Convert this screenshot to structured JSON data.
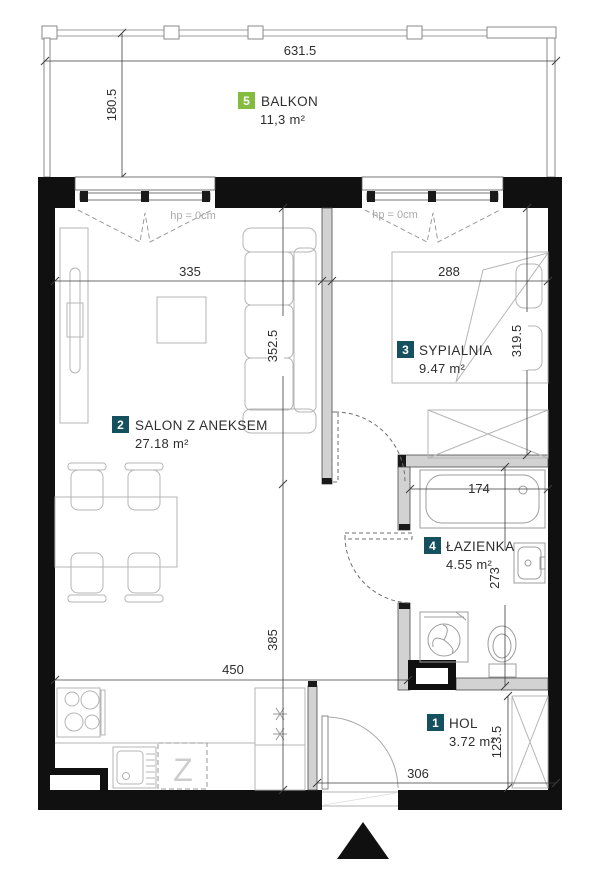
{
  "rooms": {
    "hol": {
      "number": "1",
      "name": "HOL",
      "area": "3.72 m²"
    },
    "salon": {
      "number": "2",
      "name": "SALON Z ANEKSEM",
      "area": "27.18 m²"
    },
    "sypialnia": {
      "number": "3",
      "name": "SYPIALNIA",
      "area": "9.47 m²"
    },
    "lazienka": {
      "number": "4",
      "name": "ŁAZIENKA",
      "area": "4.55 m²"
    },
    "balkon": {
      "number": "5",
      "name": "BALKON",
      "area": "11,3 m²"
    }
  },
  "dimensions_cm": {
    "balcony_width": "631.5",
    "balcony_depth": "180.5",
    "salon_width": "335",
    "salon_depth": "352.5",
    "bedroom_width": "288",
    "bedroom_depth": "319.5",
    "bathroom_width": "174",
    "bathroom_depth": "273",
    "kitchen_zone_width": "450",
    "kitchen_zone_depth": "385",
    "hall_width": "306",
    "hall_depth": "123.5"
  },
  "windows": {
    "salon_sill_height": "hp = 0cm",
    "bedroom_sill_height": "hp = 0cm"
  },
  "appliances": {
    "dishwasher_symbol": "Z"
  },
  "colors": {
    "room_tag": "#15505e",
    "balcony_tag": "#84bc3f",
    "walls": "#101010"
  }
}
